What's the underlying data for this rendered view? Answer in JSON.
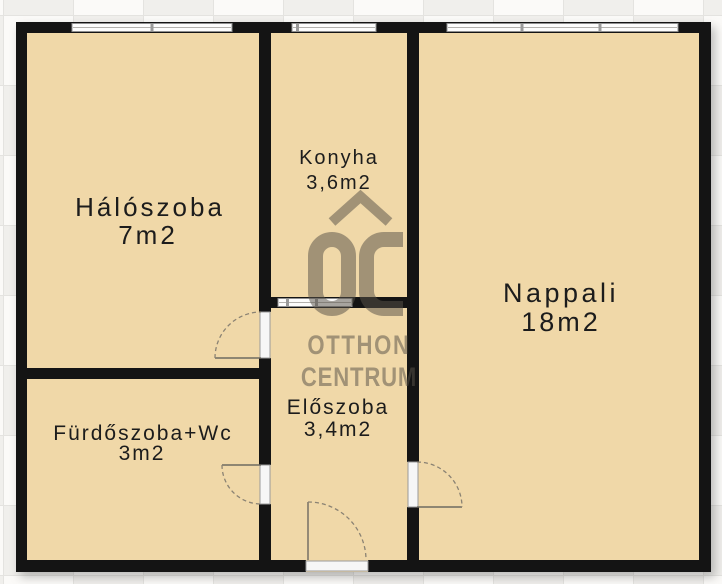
{
  "document": {
    "type": "apartment-floorplan",
    "language": "hu"
  },
  "rooms": [
    {
      "id": "haloszoba",
      "name": "Hálószoba",
      "area": "7m2"
    },
    {
      "id": "konyha",
      "name": "Konyha",
      "area": "3,6m2"
    },
    {
      "id": "nappali",
      "name": "Nappali",
      "area": "18m2"
    },
    {
      "id": "furdoszoba",
      "name": "Fürdőszoba+Wc",
      "area": "3m2"
    },
    {
      "id": "eloszoba",
      "name": "Előszoba",
      "area": "3,4m2"
    }
  ],
  "watermark": {
    "monogram": "OC",
    "line1": "OTTHON",
    "line2": "CENTRUM"
  },
  "colors": {
    "floor": "#f0d8a8",
    "wall": "#141414",
    "window_fill": "#fdfdfd",
    "window_frame": "#8f8f8f",
    "door_arc": "#7d7668",
    "watermark": "#a29a89",
    "background_tile_light": "#fbfaf8",
    "background_tile_dark": "#f0efec"
  }
}
